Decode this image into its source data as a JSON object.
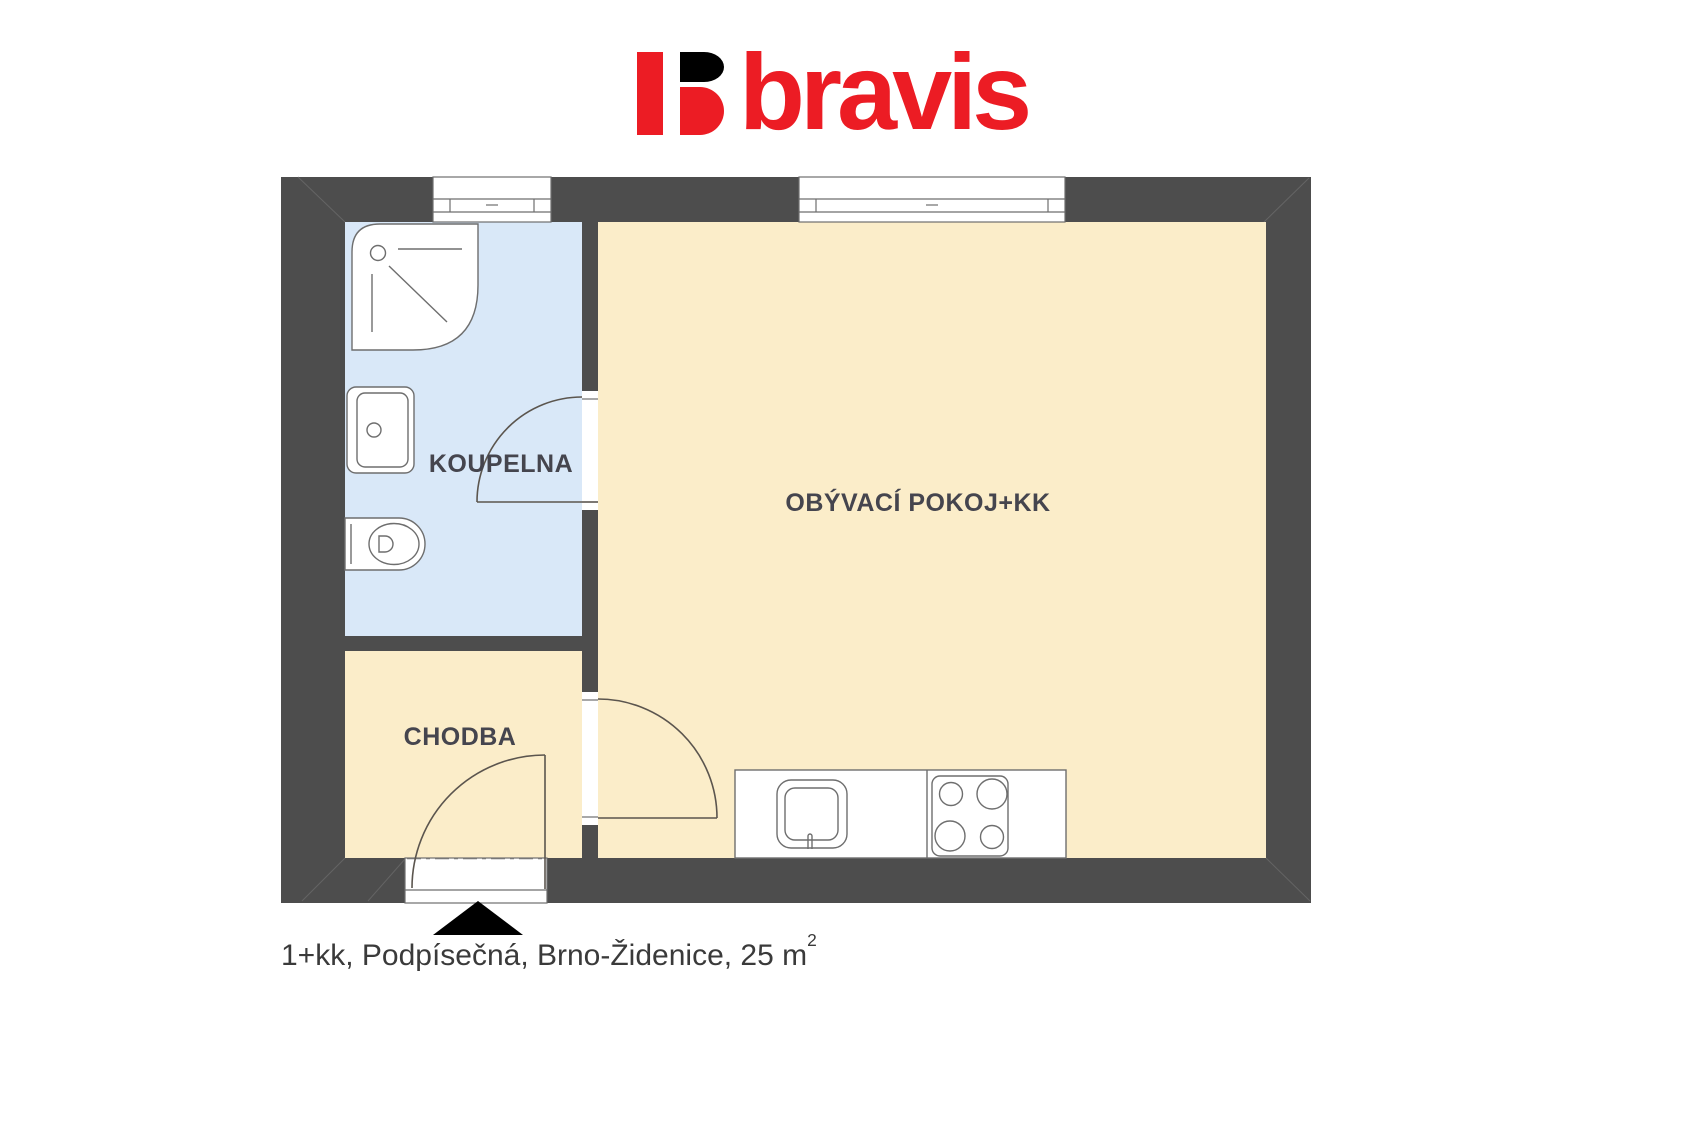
{
  "brand": {
    "logo_text": "bravis"
  },
  "floorplan": {
    "rooms": [
      {
        "id": "koupelna",
        "label": "KOUPELNA",
        "fill": "#D9E8F8"
      },
      {
        "id": "chodba",
        "label": "CHODBA",
        "fill": "#FBEDC9"
      },
      {
        "id": "obyvaci-pokoj-kk",
        "label": "OBÝVACÍ POKOJ+KK",
        "fill": "#FBEDC9"
      }
    ],
    "fixtures": [
      "shower",
      "washbasin",
      "toilet",
      "kitchen-sink",
      "stove"
    ],
    "windows": 2,
    "doors": 3
  },
  "caption": {
    "text": "1+kk, Podpísečná, Brno-Židenice, 25 m",
    "superscript": "2"
  },
  "colors": {
    "wall": "#4D4D4D",
    "bathroom": "#D9E8F8",
    "room": "#FBEDC9",
    "fixture-outline": "#6E6E6E",
    "door-line": "#5B554E",
    "label-text": "#45454E",
    "brand-red": "#EC1C24",
    "brand-black": "#000000",
    "caption-text": "#3A3A3A"
  }
}
